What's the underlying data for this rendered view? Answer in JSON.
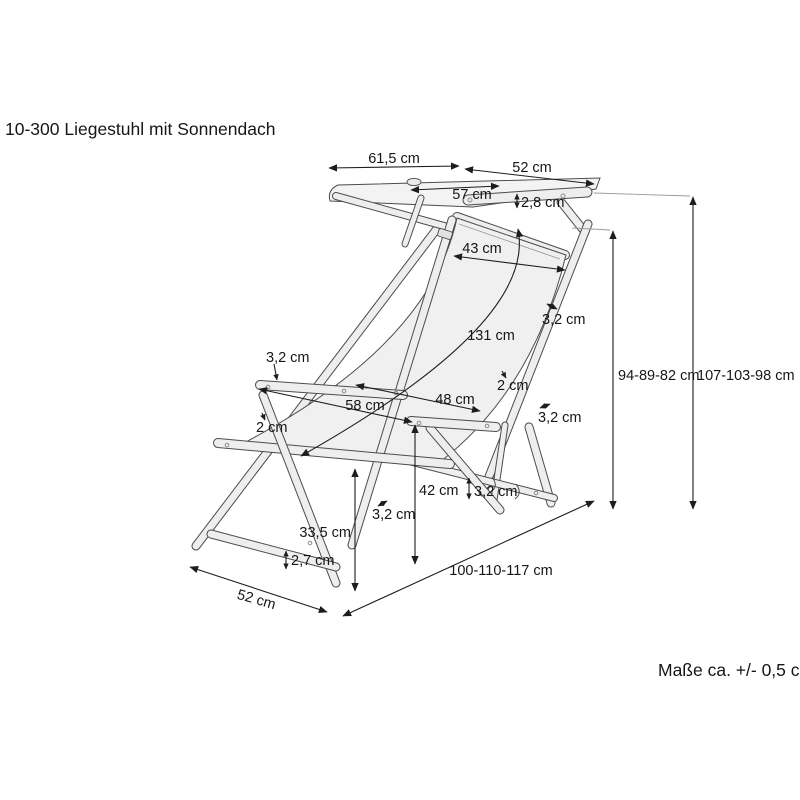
{
  "title": "10-300 Liegestuhl mit Sonnendach",
  "note": "Maße ca. +/- 0,5 cm",
  "colors": {
    "outline": "#4c4c4c",
    "dimension_line": "#1d1d1d",
    "fabric_fill": "#f0f0f0",
    "bar_fill": "#eeeeee",
    "background": "#ffffff"
  },
  "dims": {
    "canopy_left": "61,5 cm",
    "canopy_right": "52 cm",
    "canopy_depth": "57 cm",
    "canopy_bar_thickness": "2,8 cm",
    "fabric_top_width": "43 cm",
    "fabric_length": "131 cm",
    "back_rail_thickness": "3,2 cm",
    "hem_right": "2 cm",
    "seat_width": "48 cm",
    "armrest_length": "58 cm",
    "armrest_thickness": "3,2 cm",
    "hem_left": "2 cm",
    "rear_leg_thickness": "3,2 cm",
    "armrest_height": "42 cm",
    "front_leg_thickness": "3,2 cm",
    "seat_height": "33,5 cm",
    "adjust_bar_thickness": "3,2 cm",
    "cross_bar_thickness": "2,7 cm",
    "base_width": "52 cm",
    "base_depth": "100-110-117 cm",
    "back_height": "94-89-82 cm",
    "total_height": "107-103-98 cm"
  }
}
